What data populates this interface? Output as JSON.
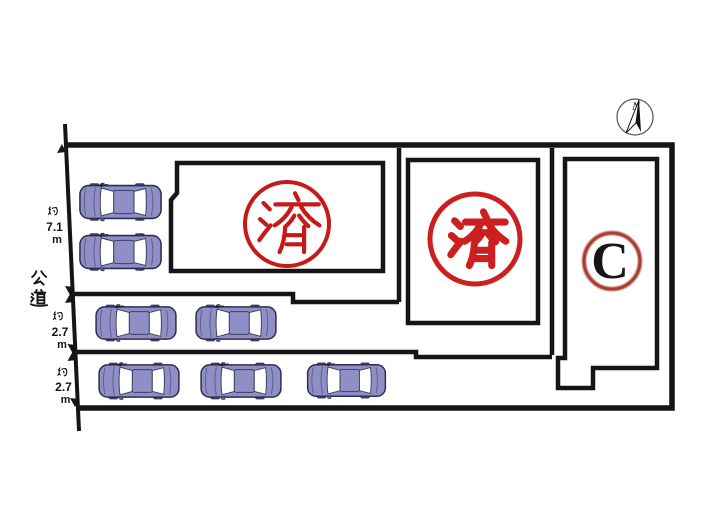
{
  "road": {
    "label": "公道"
  },
  "dimensions": [
    {
      "prefix": "約",
      "value": "7.1",
      "unit": "m"
    },
    {
      "prefix": "約",
      "value": "2.7",
      "unit": "m"
    },
    {
      "prefix": "約",
      "value": "2.7",
      "unit": "m"
    }
  ],
  "compass": {
    "north_label": "N"
  },
  "lots": [
    {
      "id": "lot-1",
      "stamp": "済",
      "stamp_style": "serif-seal",
      "stamp_color": "#c41a1a"
    },
    {
      "id": "lot-2",
      "stamp": "済",
      "stamp_style": "bold-seal",
      "stamp_color": "#cc1f1f"
    },
    {
      "id": "lot-3",
      "stamp": "C",
      "stamp_style": "letter-seal",
      "circle_color": "#a8392e",
      "letter_color": "#161616"
    }
  ],
  "cars": {
    "total": 7,
    "rows": [
      2,
      2,
      3
    ],
    "body_color": "#8f8fc5"
  },
  "colors": {
    "line": "#151515",
    "background": "#ffffff"
  }
}
